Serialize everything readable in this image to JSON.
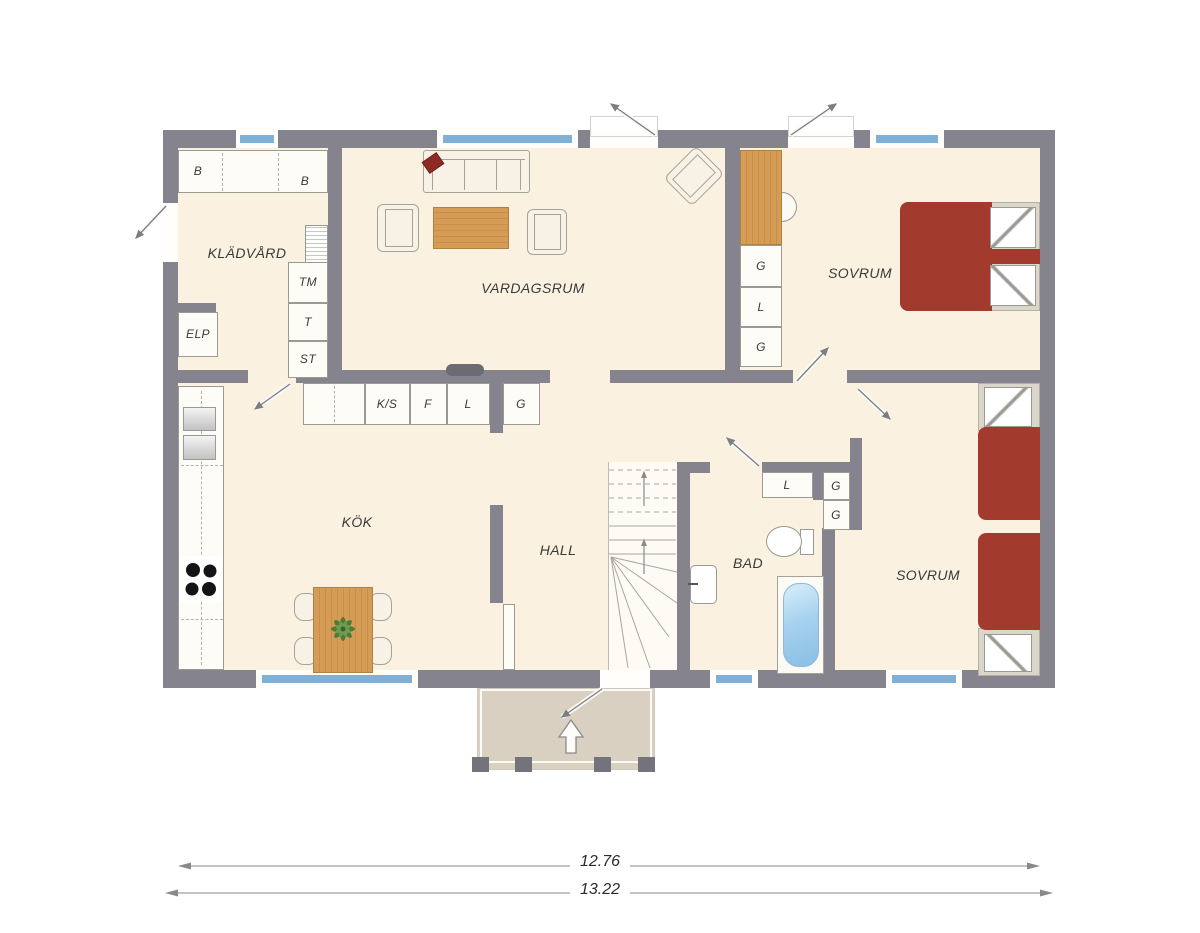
{
  "plan_title": "1-story house floor plan",
  "rooms": {
    "kladvard": "KLÄDVÅRD",
    "vardagsrum": "VARDAGSRUM",
    "sovrum1": "SOVRUM",
    "kok": "KÖK",
    "hall": "HALL",
    "bad": "BAD",
    "sovrum2": "SOVRUM"
  },
  "closets": {
    "b1": "B",
    "b2": "B",
    "tm": "TM",
    "t": "T",
    "st": "ST",
    "elp": "ELP",
    "g1": "G",
    "l1": "L",
    "g2": "G",
    "ks": "K/S",
    "f": "F",
    "l_kok": "L",
    "g_kok": "G",
    "l_bad": "L",
    "g_bad1": "G",
    "g_bad2": "G"
  },
  "dimensions": {
    "inner_width": "12.76",
    "outer_width": "13.22"
  },
  "colors": {
    "wall": "#85848e",
    "floor": "#faf1e0",
    "window_glass": "#7fb0d8",
    "bed_red": "#a23b2e",
    "pillow_red": "#8e2a24",
    "wood": "#d59c57",
    "porch": "#d9d0c1"
  }
}
